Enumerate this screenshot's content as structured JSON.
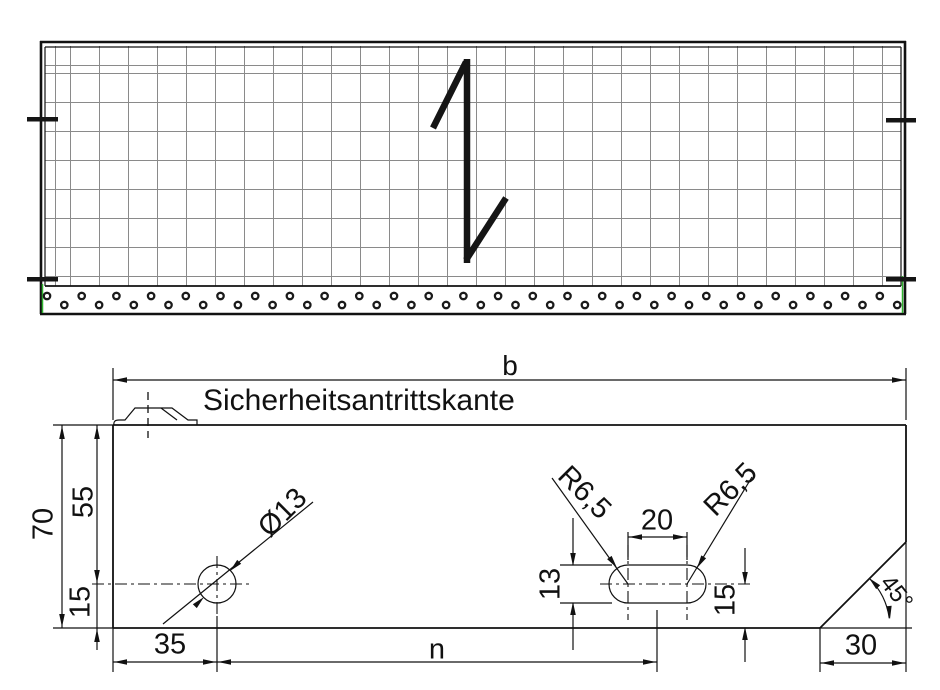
{
  "labels": {
    "width": "b",
    "safety_edge": "Sicherheitsantrittskante",
    "total_height": "70",
    "upper_height": "55",
    "lower_height": "15",
    "hole_offset": "35",
    "hole_spacing": "n",
    "hole_diameter": "Ø13",
    "slot_radius_left": "R6,5",
    "slot_radius_right": "R6,5",
    "slot_length": "20",
    "slot_width": "13",
    "slot_edge_distance": "15",
    "chamfer_width": "30",
    "chamfer_angle": "45°"
  },
  "top_view": {
    "perforation_count": 50
  },
  "colors": {
    "line": "#111111",
    "grid": "#8a8a8a",
    "accent_green": "#2fb32f"
  }
}
